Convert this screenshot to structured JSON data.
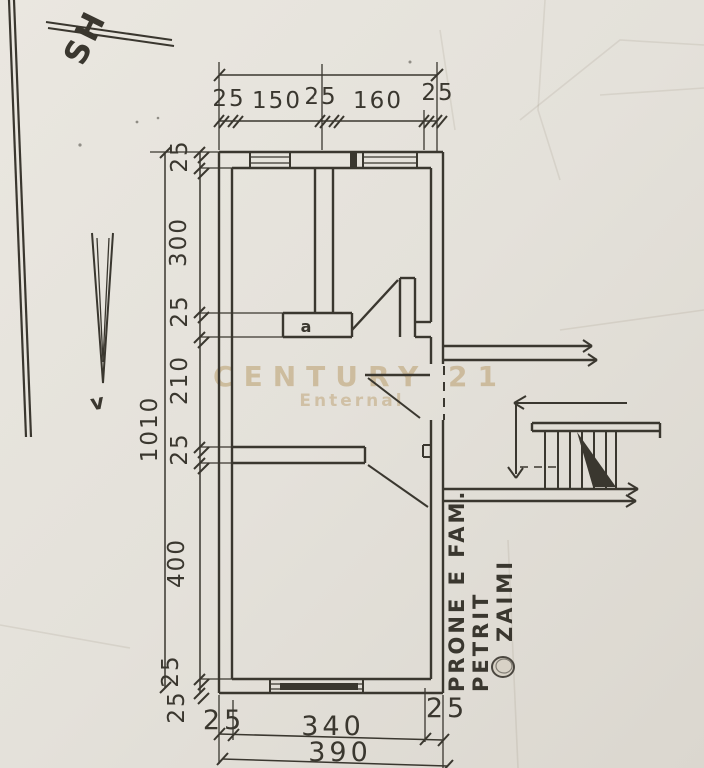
{
  "page": {
    "background_color": "#e6e3dc",
    "ink_color": "#3a372f"
  },
  "watermark": {
    "brand": "CENTURY 21",
    "sub": "Enternal",
    "color": "#b5955e"
  },
  "notes": {
    "corner": "SH",
    "arrow_letter": "v",
    "door_label": "a",
    "owner_line1": "PRONE E FAM.",
    "owner_line2": "PETRIT",
    "owner_line3": "ZAIMI"
  },
  "dimensions": {
    "top_chain": [
      "25",
      "150",
      "25",
      "160",
      "25"
    ],
    "left_overall": "1010",
    "left_chain": [
      "25",
      "300",
      "25",
      "210",
      "25",
      "400",
      "25",
      "25"
    ],
    "bottom_chain": [
      "25",
      "340",
      "25"
    ],
    "bottom_overall": "390"
  }
}
